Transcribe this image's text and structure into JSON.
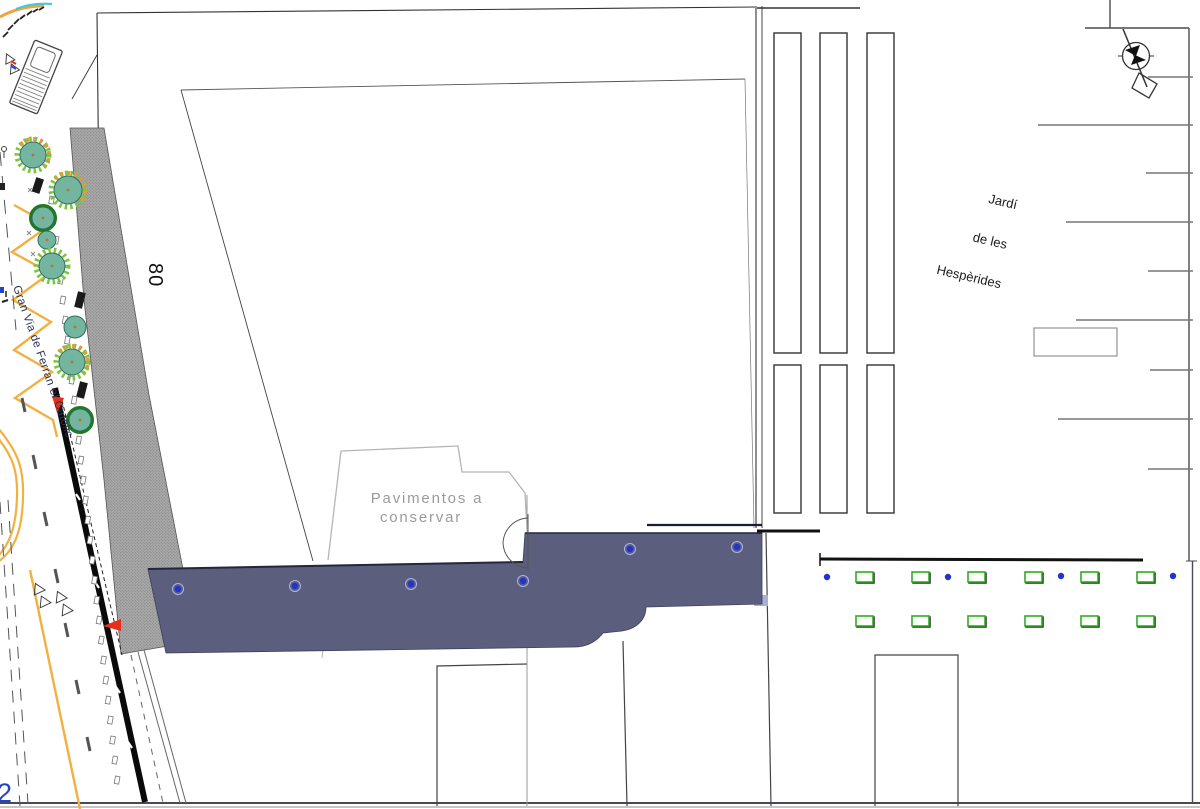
{
  "labels": {
    "street_name": "Gran Via de Ferran el Catòlic",
    "block_number": "80",
    "pavimentos_line1": "Pavimentos a",
    "pavimentos_line2": "conservar",
    "jardi_line1": "Jardí",
    "jardi_line2": "de les",
    "jardi_line3": "Hespèrides",
    "corner_mark": "2"
  },
  "colors": {
    "pavement": "#5b5f7d",
    "pavement_edge": "#23263c",
    "pavement_fringe": "#a9aed2",
    "sidewalk_hatch_bg": "#a9a9a9",
    "sidewalk_hatch_dot": "#7f7f7f",
    "tree_fill": "#74b5a0",
    "tree_stroke": "#2e6e5e",
    "tree_fringe_green": "#7cc63f",
    "tree_fringe_orange": "#e09a3c",
    "tree_ring_dark": "#1e7a1e",
    "road_yellow": "#f2b040",
    "marker_blue": "#2334cc",
    "marker_halo": "#aab4f0",
    "planter_green": "#2fae1f",
    "accent_red": "#e62e1b",
    "line_dark": "#333333",
    "line_gray": "#777777",
    "text_gray": "#9b9b9b",
    "text_dark": "#1c1c1c",
    "cyan": "#45c8d8"
  },
  "pavement_markers": [
    [
      178,
      589
    ],
    [
      295,
      586
    ],
    [
      411,
      584
    ],
    [
      523,
      581
    ],
    [
      630,
      549
    ],
    [
      737,
      547
    ]
  ],
  "trees": [
    {
      "x": 33,
      "y": 155,
      "r": 13,
      "style": "fringe-orange"
    },
    {
      "x": 68,
      "y": 190,
      "r": 14,
      "style": "fringe-orange"
    },
    {
      "x": 43,
      "y": 218,
      "r": 11,
      "style": "ring"
    },
    {
      "x": 47,
      "y": 240,
      "r": 9,
      "style": "plain"
    },
    {
      "x": 52,
      "y": 266,
      "r": 13,
      "style": "fringe"
    },
    {
      "x": 75,
      "y": 327,
      "r": 11,
      "style": "plain"
    },
    {
      "x": 72,
      "y": 362,
      "r": 13,
      "style": "fringe-orange"
    },
    {
      "x": 80,
      "y": 420,
      "r": 11,
      "style": "ring"
    }
  ],
  "planters": {
    "xs": [
      856,
      912,
      968,
      1025,
      1081,
      1137
    ],
    "rows": [
      572,
      616
    ],
    "w": 17,
    "h": 10
  },
  "plaza_dots": [
    [
      827,
      577
    ],
    [
      948,
      577
    ],
    [
      1061,
      576
    ],
    [
      1173,
      576
    ]
  ],
  "parking_lines": [
    [
      77,
      1148
    ],
    [
      125,
      1038
    ],
    [
      173,
      1146
    ],
    [
      222,
      1066
    ],
    [
      271,
      1148
    ],
    [
      320,
      1076
    ],
    [
      370,
      1150
    ],
    [
      419,
      1058
    ],
    [
      469,
      1148
    ]
  ],
  "garden_beds": {
    "xs": [
      774,
      820,
      867
    ],
    "w": 27,
    "sets": [
      {
        "y": 33,
        "h": 320
      },
      {
        "y": 365,
        "h": 148
      }
    ]
  },
  "road_dashes": {
    "start": [
      50,
      196
    ],
    "step": [
      2.26,
      20
    ],
    "count": 30
  }
}
